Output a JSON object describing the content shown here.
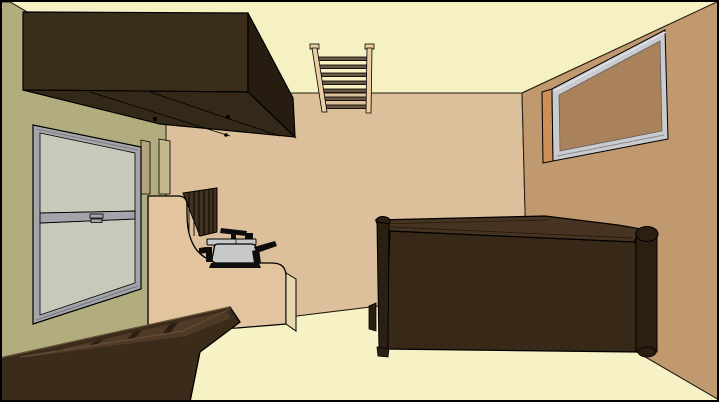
{
  "scene": {
    "description": "Flat-shaded 3D rendering of a room interior viewed from one corner",
    "objects": [
      "ceiling",
      "floor",
      "left-wall",
      "back-wall",
      "right-wall",
      "wall-cabinet",
      "double-hung-window",
      "ladder-rack",
      "framed-board",
      "kitchen-counter",
      "slatted-panel",
      "pressure-cooker",
      "storage-bed-frame",
      "table"
    ]
  },
  "colors": {
    "border": "#000000",
    "outline": "#000000",
    "ceiling": "#f5f1c3",
    "floor": "#f6f2c6",
    "wall_left": "#b1ad7f",
    "wall_back": "#dcbf9b",
    "wall_right": "#c0996e",
    "cabinet_front": "#3a2d1b",
    "cabinet_side": "#261c0f",
    "cabinet_bottom": "#342918",
    "window_frame": "#a3a5ab",
    "window_frame_dark": "#75777c",
    "window_glass": "#c8c9ba",
    "window_trim": "#b5a47c",
    "corner_trim": "#c3b78c",
    "ladder_rail": "#e9cfa1",
    "ladder_rung": "#6d583f",
    "board_edge": "#cd8f58",
    "board_frame": "#c9cbcf",
    "board_face": "#a9825c",
    "counter": "#e2c59e",
    "counter_side": "#e9d8ad",
    "slat_panel": "#43321f",
    "pot_body": "#c6c8ca",
    "pot_black": "#0d0d0d",
    "bed_front": "#3a2b1a",
    "bed_interior": "#4e3a26",
    "bed_slat": "#2b1f12",
    "bed_highlight": "#6b5338",
    "table_front": "#372817",
    "table_top": "#463321",
    "table_post": "#2b1f11"
  }
}
